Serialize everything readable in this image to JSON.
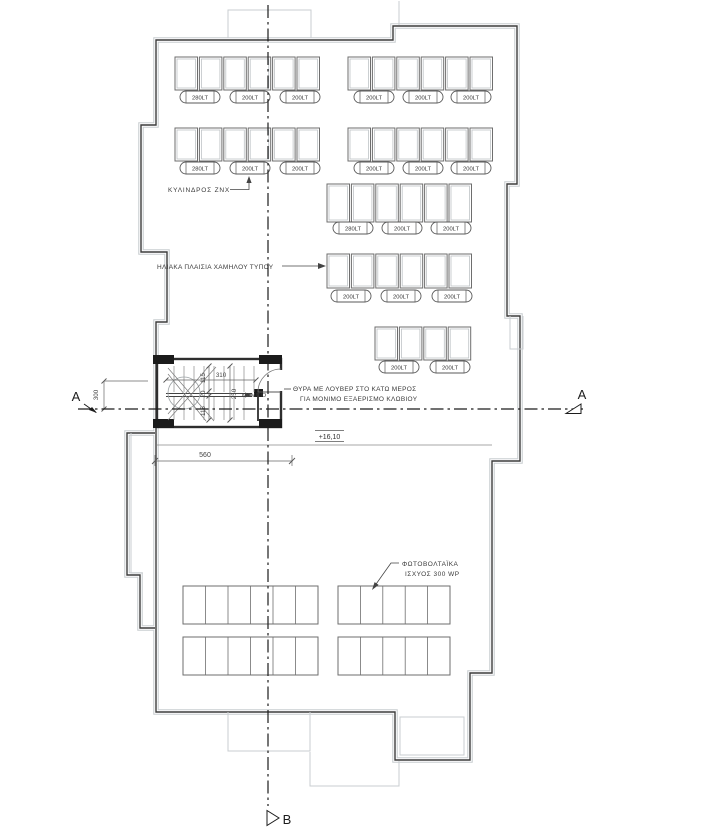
{
  "drawing": {
    "annotations": {
      "cylinder": "ΚΥΛΙΝΔΡΟΣ ΖΝΧ",
      "solar_panels": "ΗΛΙΑΚΑ ΠΛΑΙΣΙΑ ΧΑΜΗΛΟΥ ΤΥΠΟΥ",
      "door_note_line1": "ΘΥΡΑ ΜΕ ΛΟΥΒΕΡ ΣΤΟ ΚΑΤΩ ΜΕΡΟΣ",
      "door_note_line2": "ΓΙΑ ΜΟΝΙΜΟ ΕΞΑΕΡΙΣΜΟ ΚΛΩΒΙΟΥ",
      "pv_line1": "ΦΩΤΟΒΟΛΤΑΪΚΑ",
      "pv_line2": "ΙΣΧΥΟΣ 300 WP",
      "stair_label": "ΚΛΙΜ/ΣΙΟ",
      "elevation": "+16,10"
    },
    "dimensions": {
      "stair_interior_length": "310",
      "stair_interior_width": "250",
      "flight_width": "115",
      "flight_gap": "20",
      "stair_outer_width": "300",
      "roof_edge_to_section": "560"
    },
    "section_markers": {
      "left": "A",
      "right": "A",
      "bottom": "B"
    },
    "tank_rows": [
      {
        "labels": [
          "280LT",
          "200LT",
          "200LT",
          "200LT",
          "200LT",
          "200LT"
        ]
      },
      {
        "labels": [
          "280LT",
          "200LT",
          "200LT",
          "200LT",
          "200LT",
          "200LT"
        ]
      },
      {
        "labels": [
          "280LT",
          "200LT",
          "200LT"
        ]
      },
      {
        "labels": [
          "200LT",
          "200LT",
          "200LT"
        ]
      },
      {
        "labels": [
          "200LT",
          "200LT"
        ]
      }
    ],
    "colors": {
      "line_dark": "#3c3c3c",
      "line_light": "#c9cdd0",
      "section_line": "#1c1c1c",
      "background": "#ffffff"
    }
  }
}
